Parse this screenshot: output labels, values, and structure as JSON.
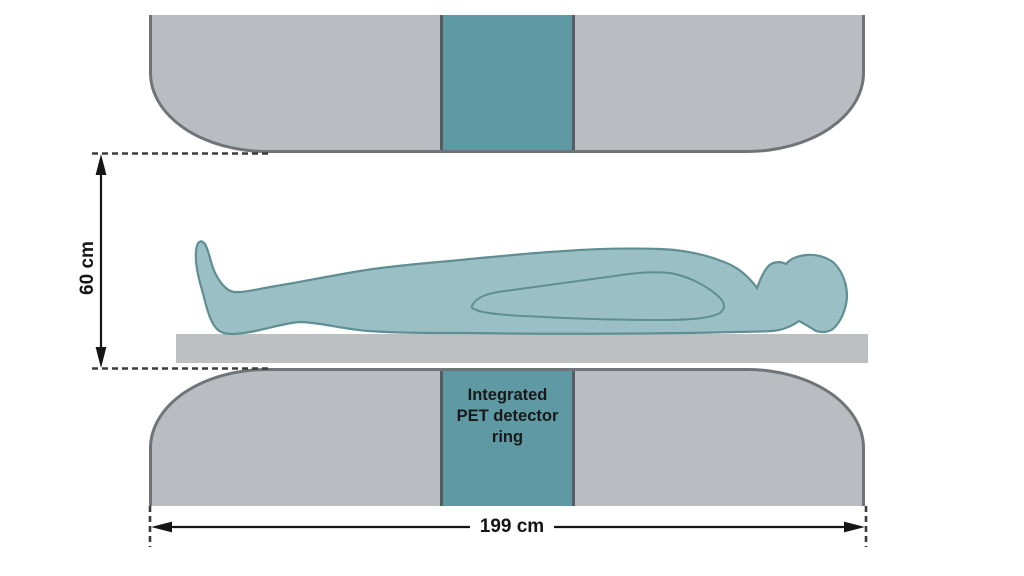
{
  "diagram": {
    "type": "schematic",
    "subject": "MR-PET scanner bore side view with patient on table",
    "detector_label_lines": [
      "Integrated",
      "PET detector",
      "ring"
    ],
    "dimensions": {
      "bore_height": "60 cm",
      "system_length": "199 cm"
    },
    "colors": {
      "machine-fill": "#b9bdc1",
      "machine-border": "#6f7478",
      "detector-fill": "#5f99a3",
      "detector-border": "#565c60",
      "body-fill": "#9abfc4",
      "body-stroke": "#5f8e93",
      "table-fill": "#bdc0c3",
      "dimension-color": "#151515"
    }
  }
}
